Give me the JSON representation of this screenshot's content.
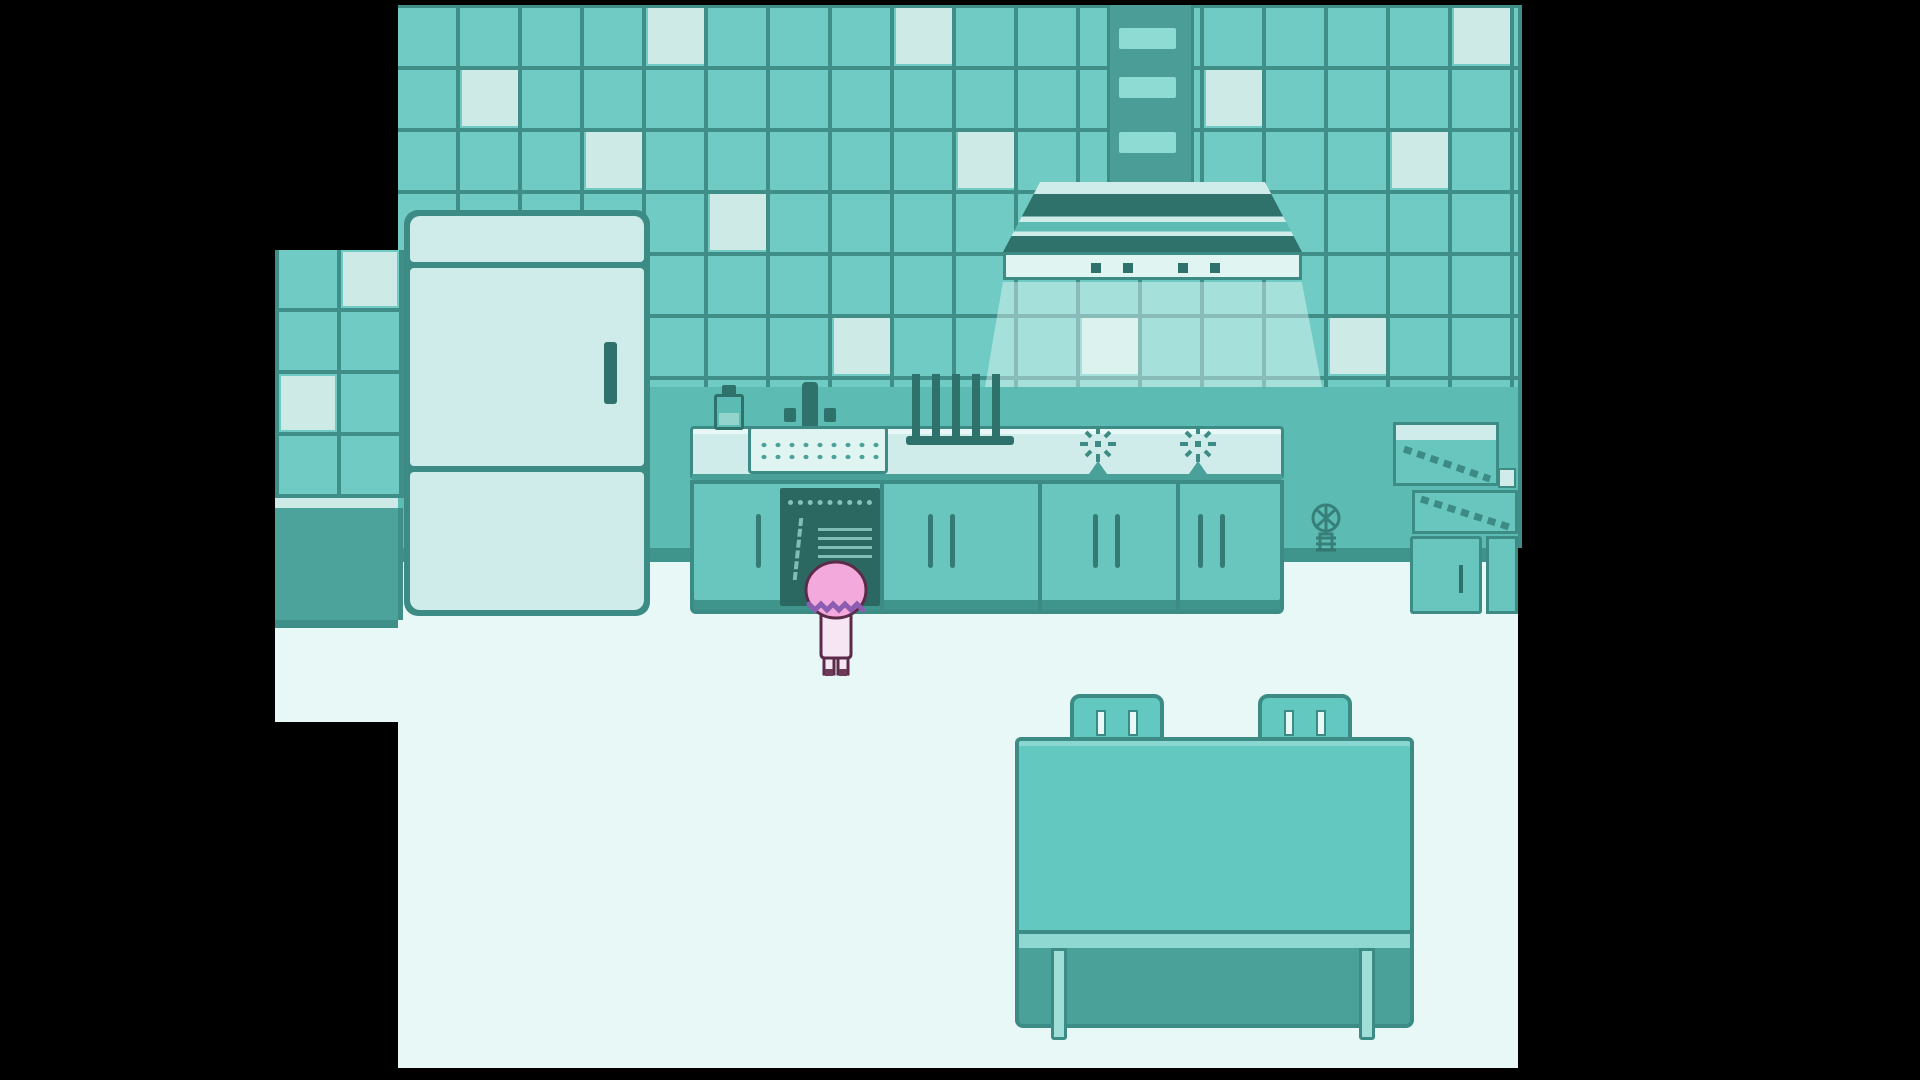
{
  "viewport": {
    "width": 1920,
    "height": 1080,
    "scene_name": "teal-pixel-kitchen"
  },
  "palette": {
    "bg": "#000000",
    "tile": "#6fcbc3",
    "tileLight": "#cdeae7",
    "grout": "#3f8e88",
    "wallLower": "#5cbcb4",
    "wallBase": "#3f948c",
    "floor": "#e7f8f7",
    "outline": "#3c8b85",
    "outlineDeep": "#2e726b",
    "applianceLight": "#cfeceb",
    "applianceLighter": "#e0f4f2",
    "cabinet": "#68c6be",
    "cabinetDark": "#49a19a",
    "interiorDark": "#2c6862",
    "interiorLines": "#93d4cc",
    "ductBody": "#4a9e97",
    "ductVent": "#8edbd3",
    "annexBase": "#4ba39b",
    "tableTeal": "#63c8c0",
    "tableEdge": "#8fd8d1",
    "tableShadow": "#49a19a",
    "legLight": "#9fdfd8",
    "glow": "rgba(240,252,250,0.42)",
    "hairPink": "#f3a9dc",
    "hairWave": "#8d5db1",
    "dressPink": "#f6e6f4",
    "charOutline": "#5c2b49",
    "feetDark": "#6b3b58"
  },
  "wall": {
    "tile_size": 62,
    "light_tiles_main": [
      [
        1,
        1
      ],
      [
        2,
        4
      ],
      [
        3,
        2
      ],
      [
        4,
        0
      ],
      [
        5,
        3
      ],
      [
        7,
        5
      ],
      [
        8,
        0
      ],
      [
        9,
        2
      ],
      [
        11,
        5
      ],
      [
        13,
        1
      ],
      [
        15,
        5
      ],
      [
        16,
        2
      ],
      [
        17,
        0
      ]
    ],
    "light_tiles_annex": [
      [
        1,
        0
      ],
      [
        0,
        2
      ]
    ]
  },
  "counter": {
    "separators_x": [
      880,
      1038,
      1176
    ],
    "handles_x": [
      756,
      928,
      950,
      1093,
      1115,
      1198,
      1220
    ]
  },
  "objects": [
    "refrigerator",
    "duct",
    "range-hood",
    "hood-light-glow",
    "soap-bottle",
    "faucet",
    "sink",
    "dish-rack",
    "stove-burners",
    "kitchen-counter",
    "open-dishwasher",
    "wall-ornament",
    "storage-boxes",
    "small-cabinets",
    "dining-table",
    "chair-backs",
    "player-character"
  ]
}
